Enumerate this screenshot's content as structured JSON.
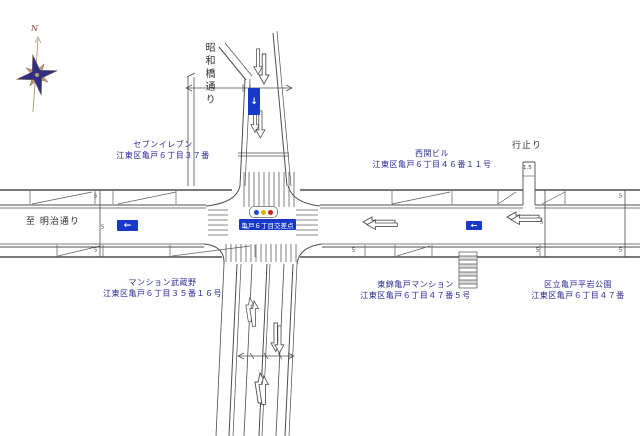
{
  "map": {
    "compass": {
      "north_label": "N"
    },
    "street_labels": {
      "showabashi_dori": "昭和橋通り",
      "to_meiji_dori": "至 明治通り",
      "dead_end": "行止り"
    },
    "intersection": {
      "name_sign": "亀戸６丁目交差点",
      "signal_icon": "traffic-light",
      "signal_colors": {
        "green": "#2244cc",
        "yellow": "#d4b400",
        "red": "#cc2020"
      }
    },
    "buildings": [
      {
        "name": "セブンイレブン",
        "address": "江東区亀戸６丁目３７番"
      },
      {
        "name": "西関ビル",
        "address": "江東区亀戸６丁目４６番１１号"
      },
      {
        "name": "マンション武蔵野",
        "address": "江東区亀戸６丁目３５番１６号"
      },
      {
        "name": "東錦亀戸マンション",
        "address": "江東区亀戸６丁目４７番５号"
      },
      {
        "name": "区立亀戸平岩公園",
        "address": "江東区亀戸６丁目４７番"
      }
    ],
    "road_markings": {
      "width_marker": "5",
      "stub_width": "1.5",
      "one_way_down_glyph": "↓",
      "one_way_left_glyph": "←"
    },
    "colors": {
      "label_blue": "#2a2a99",
      "sign_blue": "#1838c8",
      "line_gray": "#4d4d4d",
      "compass_navy": "#2e2e85",
      "compass_tan": "#bd9876"
    }
  }
}
